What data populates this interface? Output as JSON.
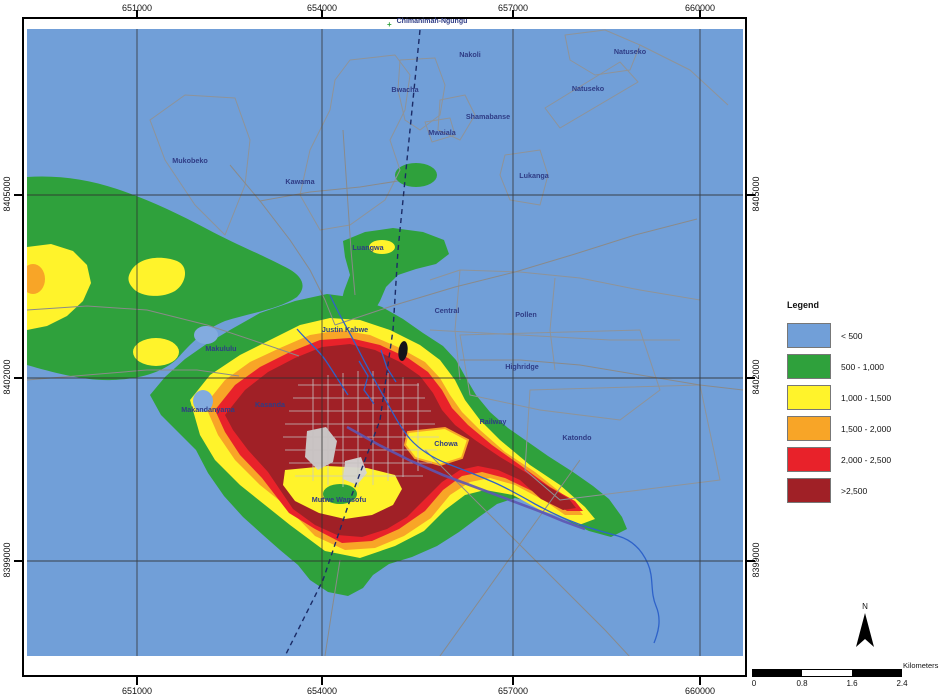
{
  "palette": {
    "blue": "#719FD8",
    "green": "#2FA13C",
    "yellow": "#FFF32B",
    "orange": "#F8A527",
    "red": "#E8222A",
    "darkred": "#A02026",
    "pond": "#82ABDF"
  },
  "map": {
    "top_place_label": "Chimanimah-Ngungu",
    "axes": {
      "top": [
        "651000",
        "654000",
        "657000",
        "660000"
      ],
      "bottom": [
        "651000",
        "654000",
        "657000",
        "660000"
      ],
      "left": [
        "8405000",
        "8402000",
        "8399000"
      ],
      "right": [
        "8405000",
        "8402000",
        "8399000"
      ]
    },
    "place_labels": [
      {
        "text": "Nakoli",
        "x": 443,
        "y": 28
      },
      {
        "text": "Natuseko",
        "x": 603,
        "y": 25
      },
      {
        "text": "Bwacha",
        "x": 378,
        "y": 63
      },
      {
        "text": "Natuseko",
        "x": 561,
        "y": 62
      },
      {
        "text": "Shamabanse",
        "x": 461,
        "y": 90
      },
      {
        "text": "Mwaiala",
        "x": 415,
        "y": 106
      },
      {
        "text": "Mukobeko",
        "x": 163,
        "y": 134
      },
      {
        "text": "Kawama",
        "x": 273,
        "y": 155
      },
      {
        "text": "Lukanga",
        "x": 507,
        "y": 149
      },
      {
        "text": "Luangwa",
        "x": 341,
        "y": 221
      },
      {
        "text": "Central",
        "x": 420,
        "y": 284
      },
      {
        "text": "Pollen",
        "x": 499,
        "y": 288
      },
      {
        "text": "Justin Kabwe",
        "x": 318,
        "y": 303
      },
      {
        "text": "Makululu",
        "x": 194,
        "y": 322
      },
      {
        "text": "Highridge",
        "x": 495,
        "y": 340
      },
      {
        "text": "Makandanyama",
        "x": 181,
        "y": 383
      },
      {
        "text": "Kasanda",
        "x": 243,
        "y": 378
      },
      {
        "text": "Railway",
        "x": 466,
        "y": 395
      },
      {
        "text": "Katondo",
        "x": 550,
        "y": 411
      },
      {
        "text": "Chowa",
        "x": 419,
        "y": 417
      },
      {
        "text": "Mutwe Wansofu",
        "x": 312,
        "y": 473
      }
    ]
  },
  "legend": {
    "title": "Legend",
    "items": [
      {
        "label": "< 500",
        "color": "#719FD8"
      },
      {
        "label": "500 - 1,000",
        "color": "#2FA13C"
      },
      {
        "label": "1,000 - 1,500",
        "color": "#FFF32B"
      },
      {
        "label": "1,500 - 2,000",
        "color": "#F8A527"
      },
      {
        "label": "2,000 - 2,500",
        "color": "#E8222A"
      },
      {
        "label": ">2,500",
        "color": "#A02026"
      }
    ]
  },
  "scalebar": {
    "ticks": [
      "0",
      "0.8",
      "1.6",
      "2.4"
    ],
    "unit": "Kilometers"
  },
  "north_arrow": {
    "label": "N"
  }
}
